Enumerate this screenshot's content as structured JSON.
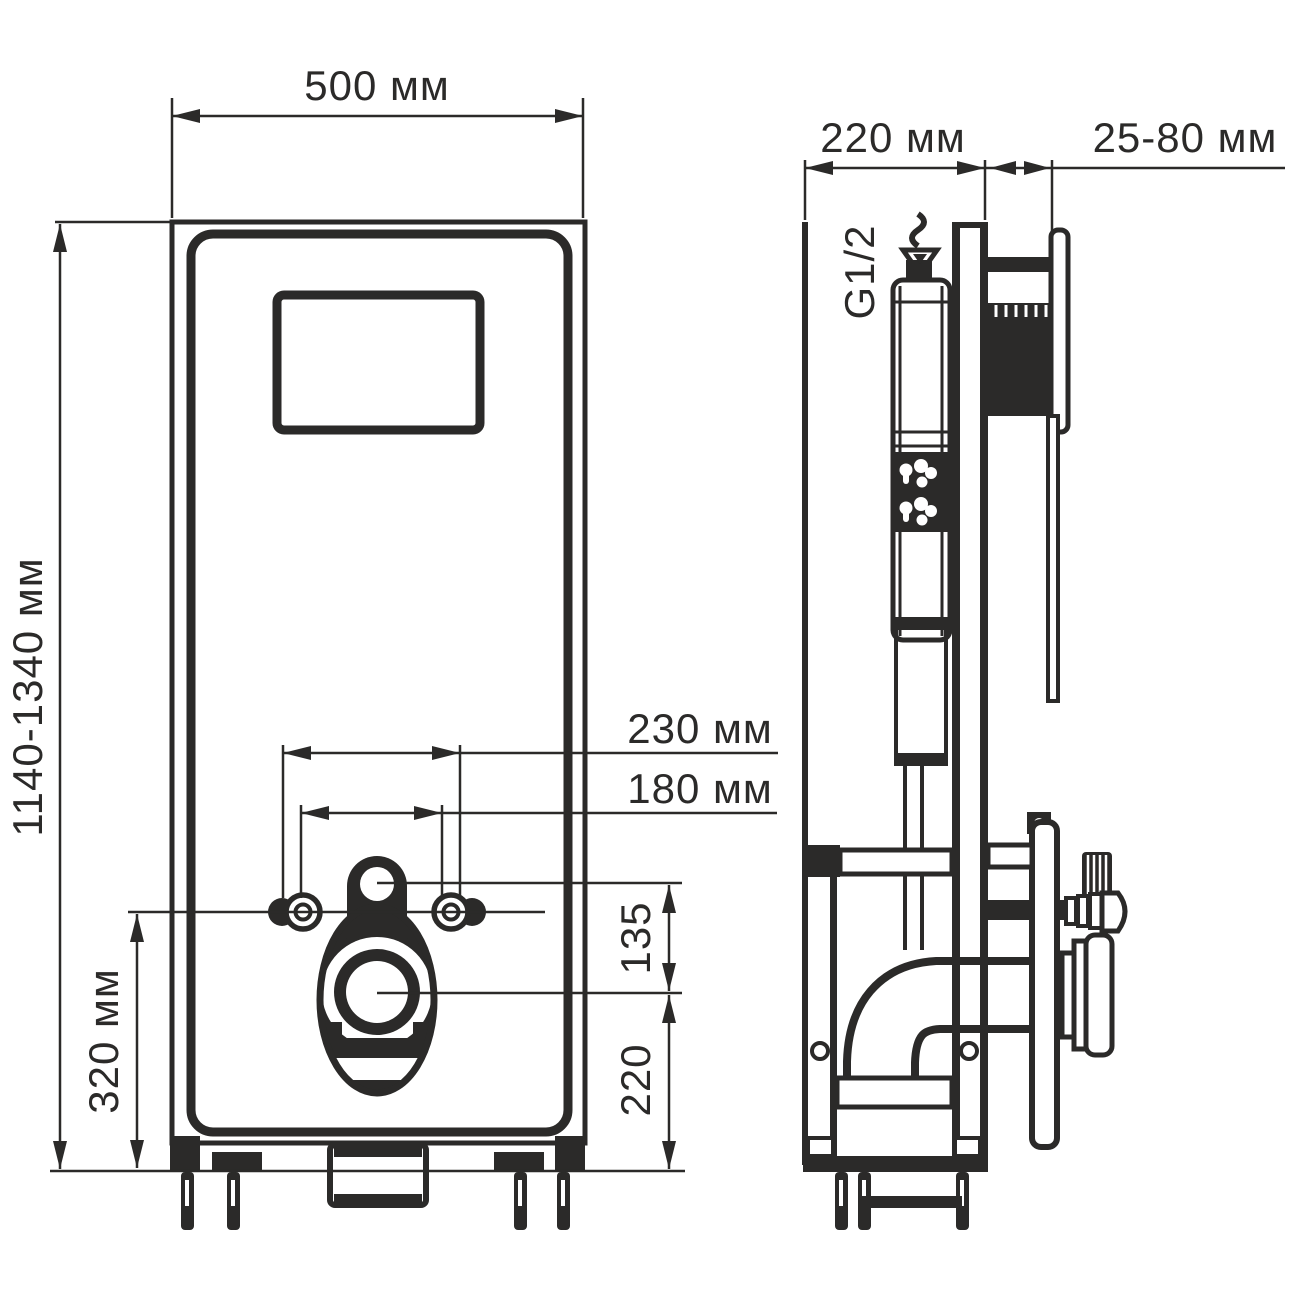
{
  "page": {
    "background": "#ffffff",
    "line_color": "#2b2a29",
    "description_units": "мм"
  },
  "front_view": {
    "width_label": "500 мм",
    "height_label": "1140-1340 мм",
    "anchor_span_outer_label": "230 мм",
    "anchor_span_inner_label": "180 мм",
    "anchor_height_label": "320 мм",
    "flush_offset_label": "135",
    "outlet_height_label": "220"
  },
  "side_view": {
    "depth_label": "220 мм",
    "wall_clearance_label": "25-80 мм",
    "water_thread_label": "G1/2"
  }
}
